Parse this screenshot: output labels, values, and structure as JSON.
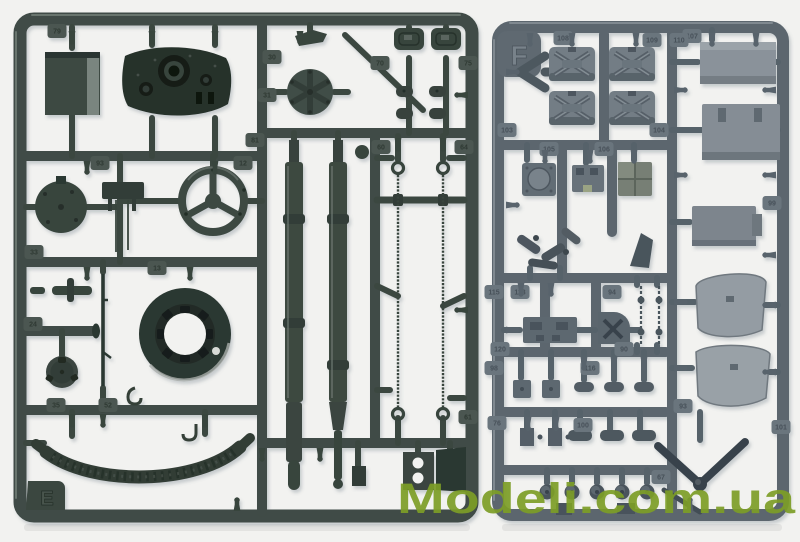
{
  "photo": {
    "subject": "Two injection-molded plastic model kit sprues with armored-vehicle parts on a white background",
    "background_color": "#f2f2f0",
    "watermark": {
      "text": "Modeli.com.ua",
      "color": "#7d9e27"
    }
  },
  "left_sprue": {
    "letter": "E",
    "plastic_color": "#404c46",
    "tags": [
      {
        "label": "79",
        "x": 57,
        "y": 31
      },
      {
        "label": "30",
        "x": 272,
        "y": 57
      },
      {
        "label": "31",
        "x": 267,
        "y": 95
      },
      {
        "label": "70",
        "x": 380,
        "y": 63
      },
      {
        "label": "75",
        "x": 468,
        "y": 63
      },
      {
        "label": "81",
        "x": 255,
        "y": 140
      },
      {
        "label": "93",
        "x": 100,
        "y": 163
      },
      {
        "label": "12",
        "x": 243,
        "y": 163
      },
      {
        "label": "60",
        "x": 381,
        "y": 147
      },
      {
        "label": "64",
        "x": 464,
        "y": 147
      },
      {
        "label": "33",
        "x": 34,
        "y": 252
      },
      {
        "label": "13",
        "x": 157,
        "y": 268
      },
      {
        "label": "24",
        "x": 33,
        "y": 324
      },
      {
        "label": "35",
        "x": 56,
        "y": 405
      },
      {
        "label": "52",
        "x": 108,
        "y": 405
      },
      {
        "label": "61",
        "x": 468,
        "y": 417
      }
    ],
    "pins": [
      [
        72,
        31,
        0
      ],
      [
        152,
        31,
        0
      ],
      [
        215,
        31,
        0
      ],
      [
        300,
        31,
        0
      ],
      [
        87,
        161,
        0
      ],
      [
        215,
        161,
        0
      ],
      [
        87,
        267,
        0
      ],
      [
        190,
        267,
        0
      ],
      [
        72,
        414,
        0
      ],
      [
        205,
        414,
        0
      ],
      [
        103,
        414,
        0
      ],
      [
        262,
        448,
        0
      ],
      [
        320,
        448,
        0
      ],
      [
        398,
        138,
        0
      ],
      [
        443,
        138,
        0
      ],
      [
        468,
        95,
        90
      ],
      [
        468,
        310,
        90
      ],
      [
        237,
        511,
        180
      ]
    ],
    "knobs": []
  },
  "right_sprue": {
    "letter": "F",
    "plastic_color": "#5b666e",
    "tags": [
      {
        "label": "107",
        "x": 692,
        "y": 36
      },
      {
        "label": "108",
        "x": 563,
        "y": 38
      },
      {
        "label": "109",
        "x": 652,
        "y": 40
      },
      {
        "label": "110",
        "x": 679,
        "y": 40
      },
      {
        "label": "103",
        "x": 507,
        "y": 130
      },
      {
        "label": "104",
        "x": 659,
        "y": 130
      },
      {
        "label": "105",
        "x": 549,
        "y": 149
      },
      {
        "label": "106",
        "x": 604,
        "y": 149
      },
      {
        "label": "99",
        "x": 772,
        "y": 203
      },
      {
        "label": "115",
        "x": 494,
        "y": 292
      },
      {
        "label": "113",
        "x": 520,
        "y": 292
      },
      {
        "label": "94",
        "x": 612,
        "y": 292
      },
      {
        "label": "120",
        "x": 500,
        "y": 349
      },
      {
        "label": "90",
        "x": 624,
        "y": 349
      },
      {
        "label": "98",
        "x": 494,
        "y": 368
      },
      {
        "label": "116",
        "x": 590,
        "y": 368
      },
      {
        "label": "93",
        "x": 683,
        "y": 406
      },
      {
        "label": "76",
        "x": 497,
        "y": 423
      },
      {
        "label": "100",
        "x": 583,
        "y": 425
      },
      {
        "label": "101",
        "x": 781,
        "y": 427
      },
      {
        "label": "67",
        "x": 661,
        "y": 477
      }
    ],
    "pins": [
      [
        530,
        33,
        0
      ],
      [
        572,
        33,
        0
      ],
      [
        636,
        33,
        0
      ],
      [
        712,
        33,
        0
      ],
      [
        756,
        33,
        0
      ],
      [
        545,
        150,
        0
      ],
      [
        590,
        150,
        0
      ],
      [
        634,
        150,
        0
      ],
      [
        521,
        283,
        0
      ],
      [
        551,
        283,
        0
      ],
      [
        584,
        357,
        0
      ],
      [
        614,
        357,
        0
      ],
      [
        644,
        357,
        0
      ],
      [
        528,
        417,
        0
      ],
      [
        556,
        417,
        0
      ],
      [
        690,
        511,
        180
      ],
      [
        506,
        72,
        -90
      ],
      [
        506,
        205,
        -90
      ],
      [
        506,
        330,
        -90
      ],
      [
        674,
        90,
        -90
      ],
      [
        674,
        175,
        -90
      ],
      [
        674,
        302,
        -90
      ],
      [
        674,
        368,
        -90
      ],
      [
        776,
        90,
        90
      ],
      [
        776,
        175,
        90
      ],
      [
        776,
        255,
        90
      ],
      [
        776,
        305,
        90
      ],
      [
        776,
        372,
        90
      ]
    ],
    "knobs": [
      [
        547,
        492
      ],
      [
        572,
        492
      ],
      [
        597,
        492
      ],
      [
        622,
        492
      ],
      [
        647,
        492
      ]
    ]
  }
}
